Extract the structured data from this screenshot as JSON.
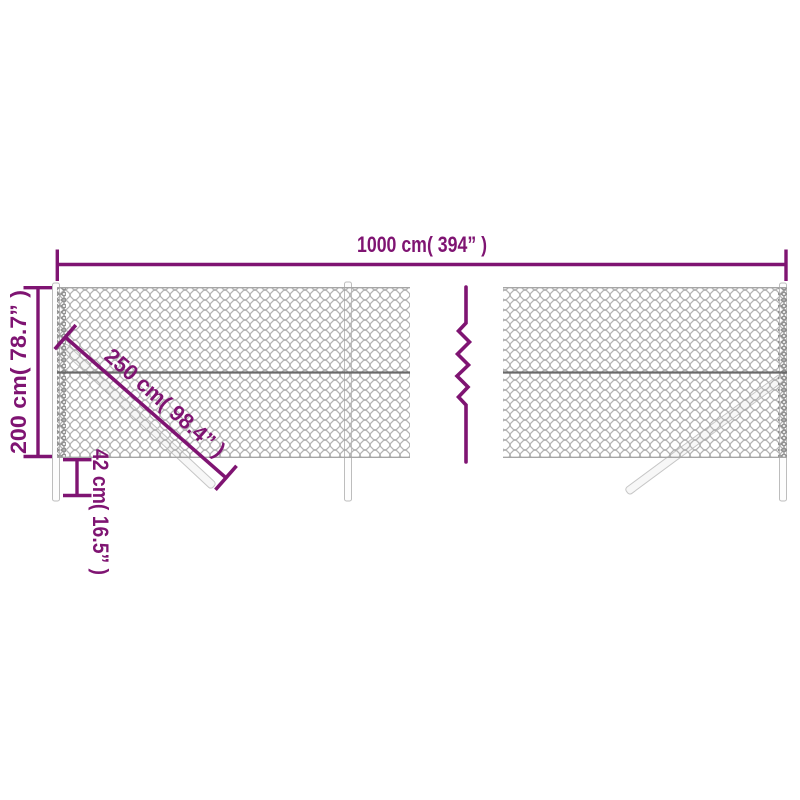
{
  "diagram": {
    "description": "chain-link fence product dimension diagram",
    "accent_color": "#7F1472",
    "mesh_color": "#B4B4B4",
    "labels": {
      "total_width": "1000 cm( 394” )",
      "fence_height": "200 cm( 78.7” )",
      "brace_length": "250 cm( 98.4” )",
      "post_ground_depth": "42 cm( 16.5” )"
    },
    "measurements": {
      "total_width_cm": 1000,
      "total_width_in": 394,
      "fence_height_cm": 200,
      "fence_height_in": 78.7,
      "brace_length_cm": 250,
      "brace_length_in": 98.4,
      "post_ground_depth_cm": 42,
      "post_ground_depth_in": 16.5
    }
  }
}
